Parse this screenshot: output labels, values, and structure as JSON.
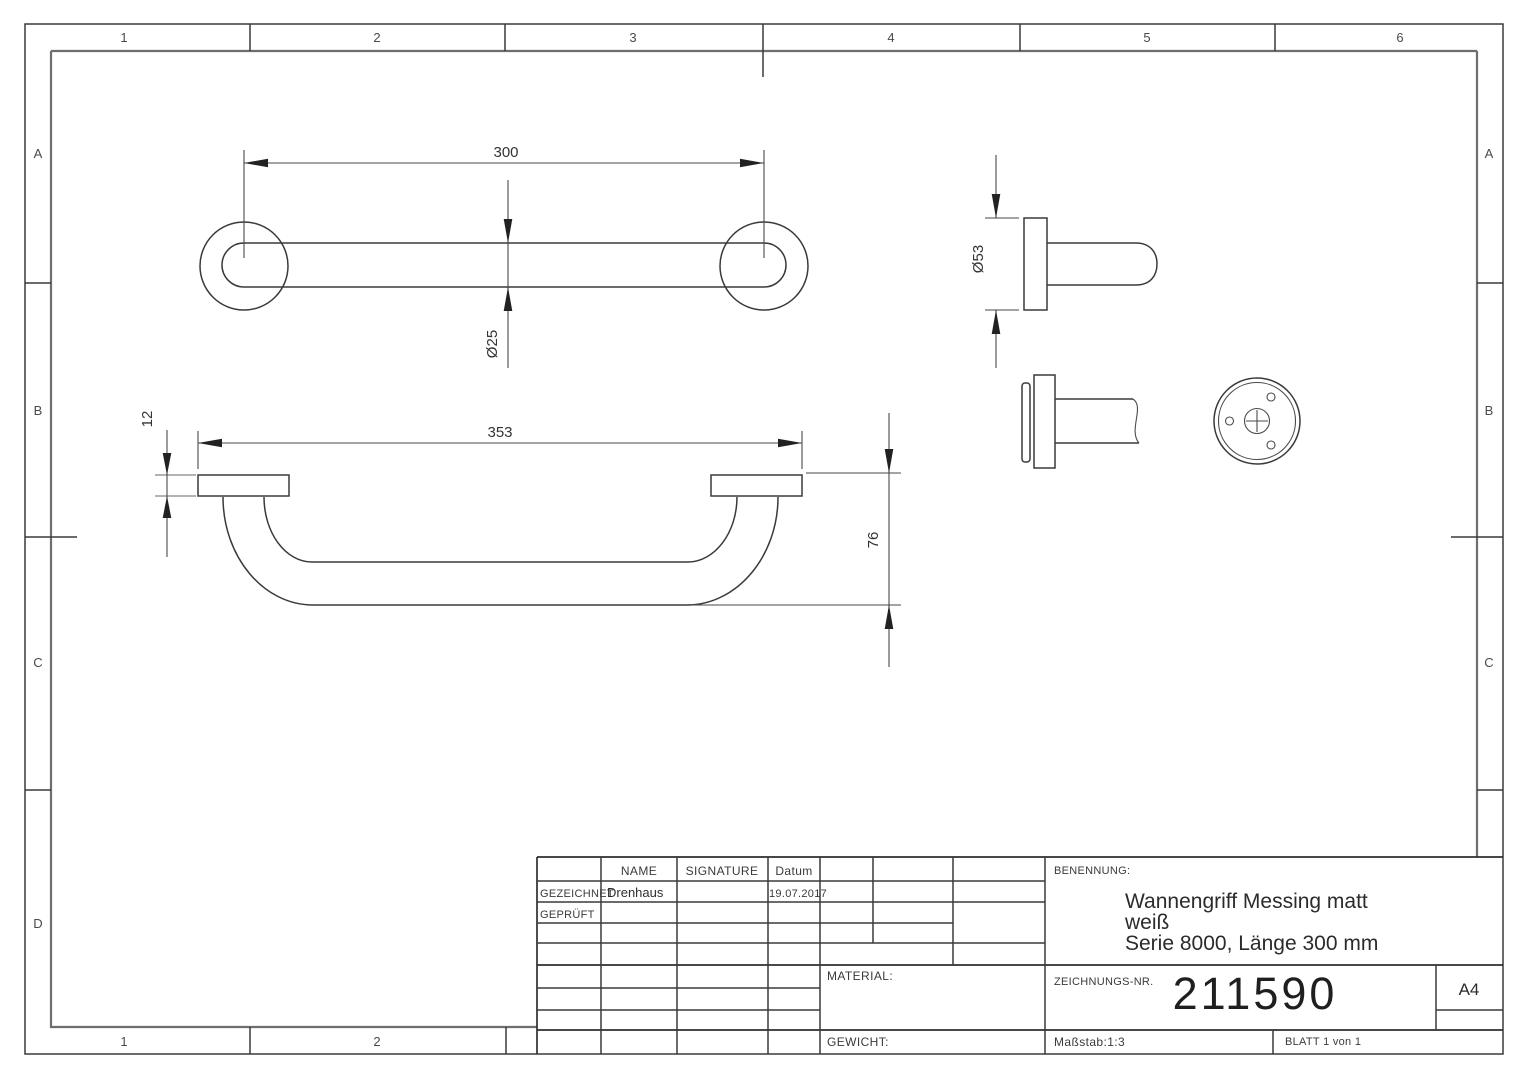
{
  "sheet": {
    "zones": {
      "top": [
        "1",
        "2",
        "3",
        "4",
        "5",
        "6"
      ],
      "bottom": [
        "1",
        "2"
      ],
      "left": [
        "A",
        "B",
        "C",
        "D"
      ],
      "right": [
        "A",
        "B",
        "C"
      ]
    },
    "dims": {
      "length": "300",
      "tube_dia": "Ø25",
      "overall": "353",
      "flange_thk": "12",
      "height": "76",
      "flange_dia": "Ø53"
    },
    "tb": {
      "name_h": "NAME",
      "signature_h": "SIGNATURE",
      "date_h": "Datum",
      "drawn_label": "GEZEICHNET",
      "drawn_name": "Drenhaus",
      "drawn_date": "19.07.2017",
      "checked_label": "GEPRÜFT",
      "material": "MATERIAL:",
      "weight": "GEWICHT:",
      "benennung": "BENENNUNG:",
      "title1": "Wannengriff Messing matt",
      "title2": "weiß",
      "title3": "Serie 8000, Länge 300 mm",
      "drawno_label": "ZEICHNUNGS-NR.",
      "drawno": "211590",
      "format": "A4",
      "scale": "Maßstab:1:3",
      "blatt": "BLATT 1 von 1"
    },
    "colors": {
      "line": "#3a3a3a",
      "frame": "#6e6e6e",
      "accent": "#222222"
    }
  }
}
